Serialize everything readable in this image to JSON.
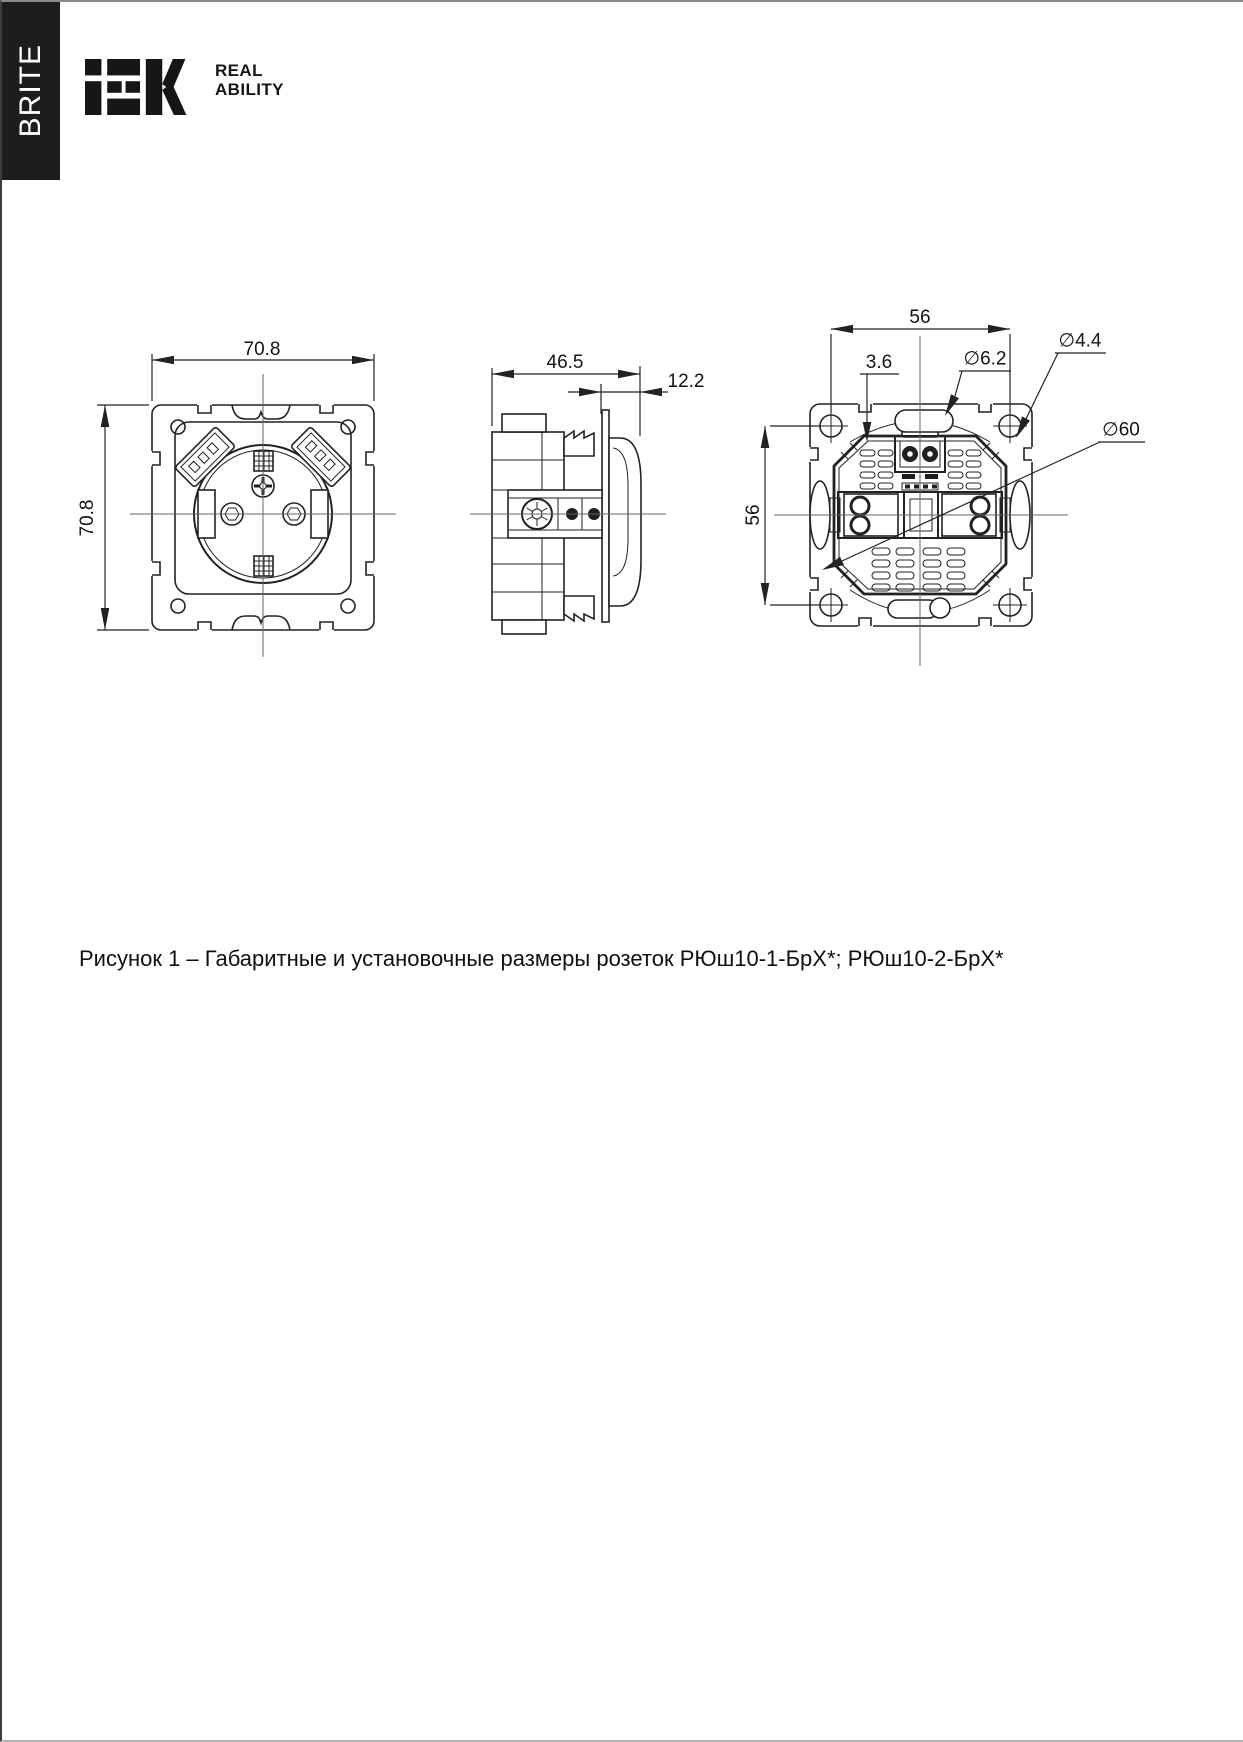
{
  "brand": {
    "series_label": "BRITE",
    "logo_alt": "IEK",
    "tagline_line1": "REAL",
    "tagline_line2": "ABILITY"
  },
  "figure": {
    "caption": "Рисунок 1 – Габаритные и установочные размеры розеток РЮш10-1-БрХ*; РЮш10-2-БрХ*",
    "views": {
      "front": {
        "width_mm": "70.8",
        "height_mm": "70.8"
      },
      "side": {
        "depth_mm": "46.5",
        "cover_depth_mm": "12.2"
      },
      "rear": {
        "mount_span_h_mm": "56",
        "mount_span_v_mm": "56",
        "claw_gap_mm": "3.6",
        "slot_diameter": "∅6.2",
        "hole_diameter": "∅4.4",
        "body_diameter": "∅60"
      }
    }
  },
  "colors": {
    "bar_bg": "#1d1d1b",
    "line": "#222222",
    "text": "#101010",
    "page_bg": "#ffffff"
  }
}
